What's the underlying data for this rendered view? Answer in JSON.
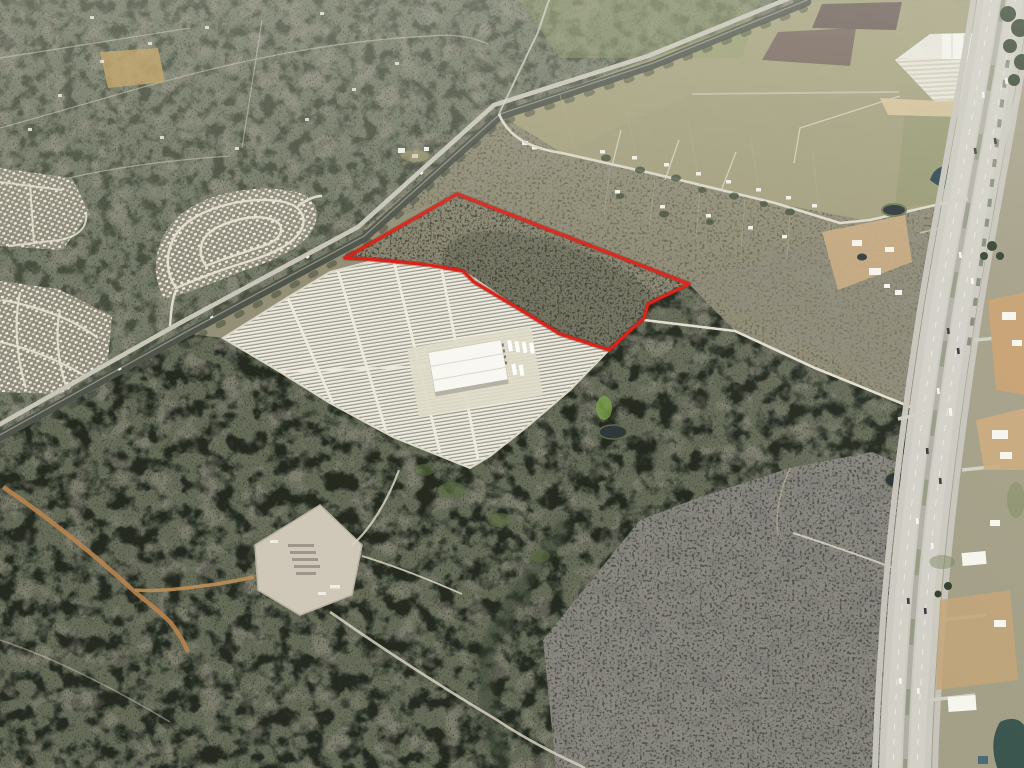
{
  "scene": {
    "type": "oblique-aerial-photo",
    "description": "Oblique aerial photo of semi-rural land; red outlined vacant parcel beside a white gridded storage yard, railroad corridor, subdivisions left, divided highway right"
  },
  "annotation": {
    "name": "property-boundary",
    "color": "#de1f15",
    "stroke_width": 3,
    "points": "457,194 689,284 648,304 644,318 609,350 560,334 516,307 474,282 463,271 430,265 400,262 368,259 345,258"
  },
  "storage_yard": {
    "name": "white-row-storage-lot",
    "outline_points": "223,338 290,296 330,272 372,261 430,264 463,271 516,307 560,334 609,350 570,390 528,426 490,456 470,468 393,437 330,403 277,370",
    "row_color": "#ecebdf",
    "ground_color": "#9a9688"
  },
  "palette": {
    "field_olive": "#949077",
    "field_light": "#a5a17c",
    "scrub_dark": "#636852",
    "brush_blotch": "#20281f",
    "mottle_gray": "#8d8984",
    "road_light": "#ded9c8",
    "dirt_orange": "#b9834e",
    "highway_gray": "#cbc9c0",
    "water_dark": "#273036",
    "building_white": "#f8f7f2",
    "plowed_brown": "#6e5b56",
    "tree_green": "#3c4a36",
    "rail_dark": "#50554b"
  },
  "features": {
    "railroad_corridor": "rail-and-road-corridor-diagonal",
    "highway": "divided-highway-right-edge",
    "subdivision_curved": "curved-street-subdivision",
    "subdivision_left": "left-edge-subdivision",
    "warehouse_complex": "white-industrial-complex-top-right",
    "gravel_pad": "cleared-gravel-pad-lower-left",
    "ponds": "stock-ponds"
  }
}
